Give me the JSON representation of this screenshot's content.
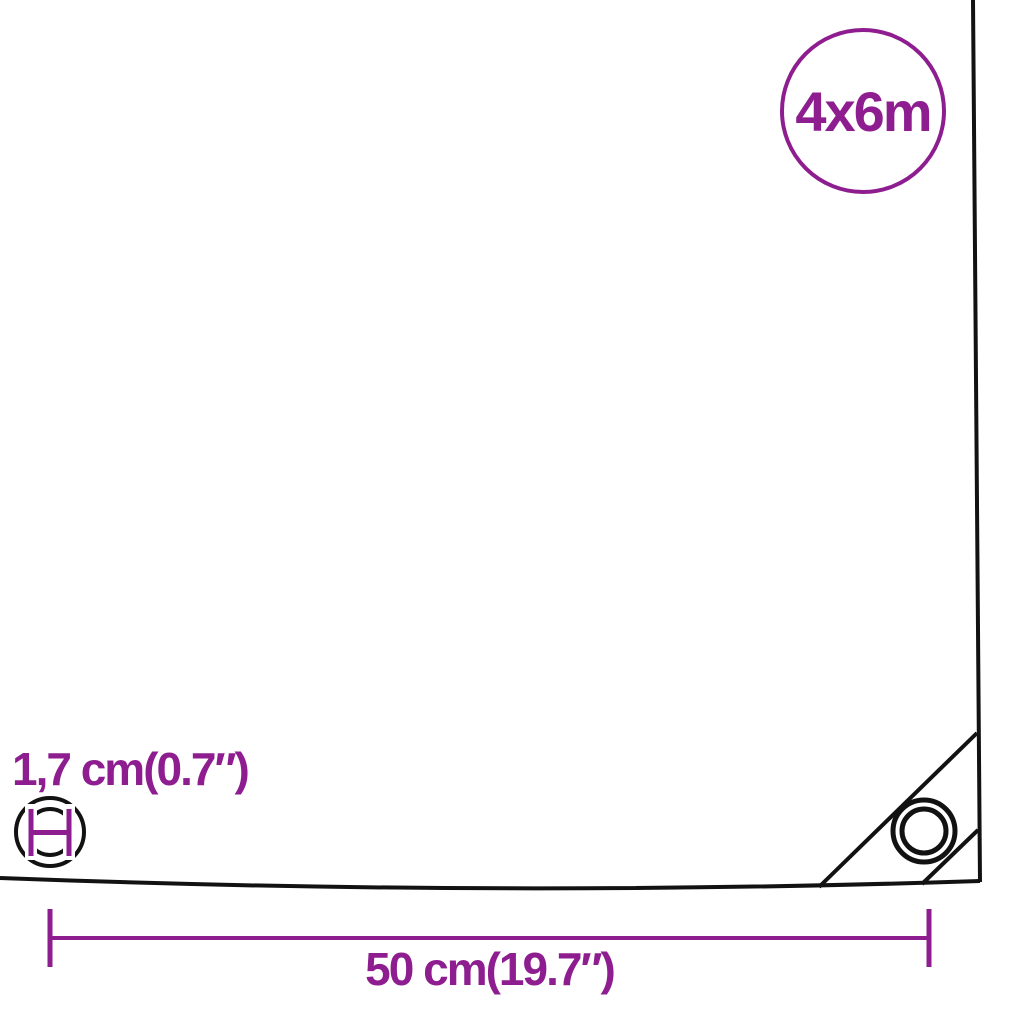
{
  "diagram": {
    "badge": {
      "label": "4x6m"
    },
    "eyelet": {
      "diameter_label": "1,7 cm(0.7″)"
    },
    "spacing": {
      "width_label": "50 cm(19.7″)"
    },
    "colors": {
      "accent": "#8E1E90",
      "line": "#121212",
      "background": "#FFFFFF"
    },
    "icons": {
      "eyelet_diameter": "double-circle-with-diameter-measure",
      "corner_grommet": "concentric-circles",
      "width_dimension": "horizontal-line-with-end-ticks"
    }
  }
}
